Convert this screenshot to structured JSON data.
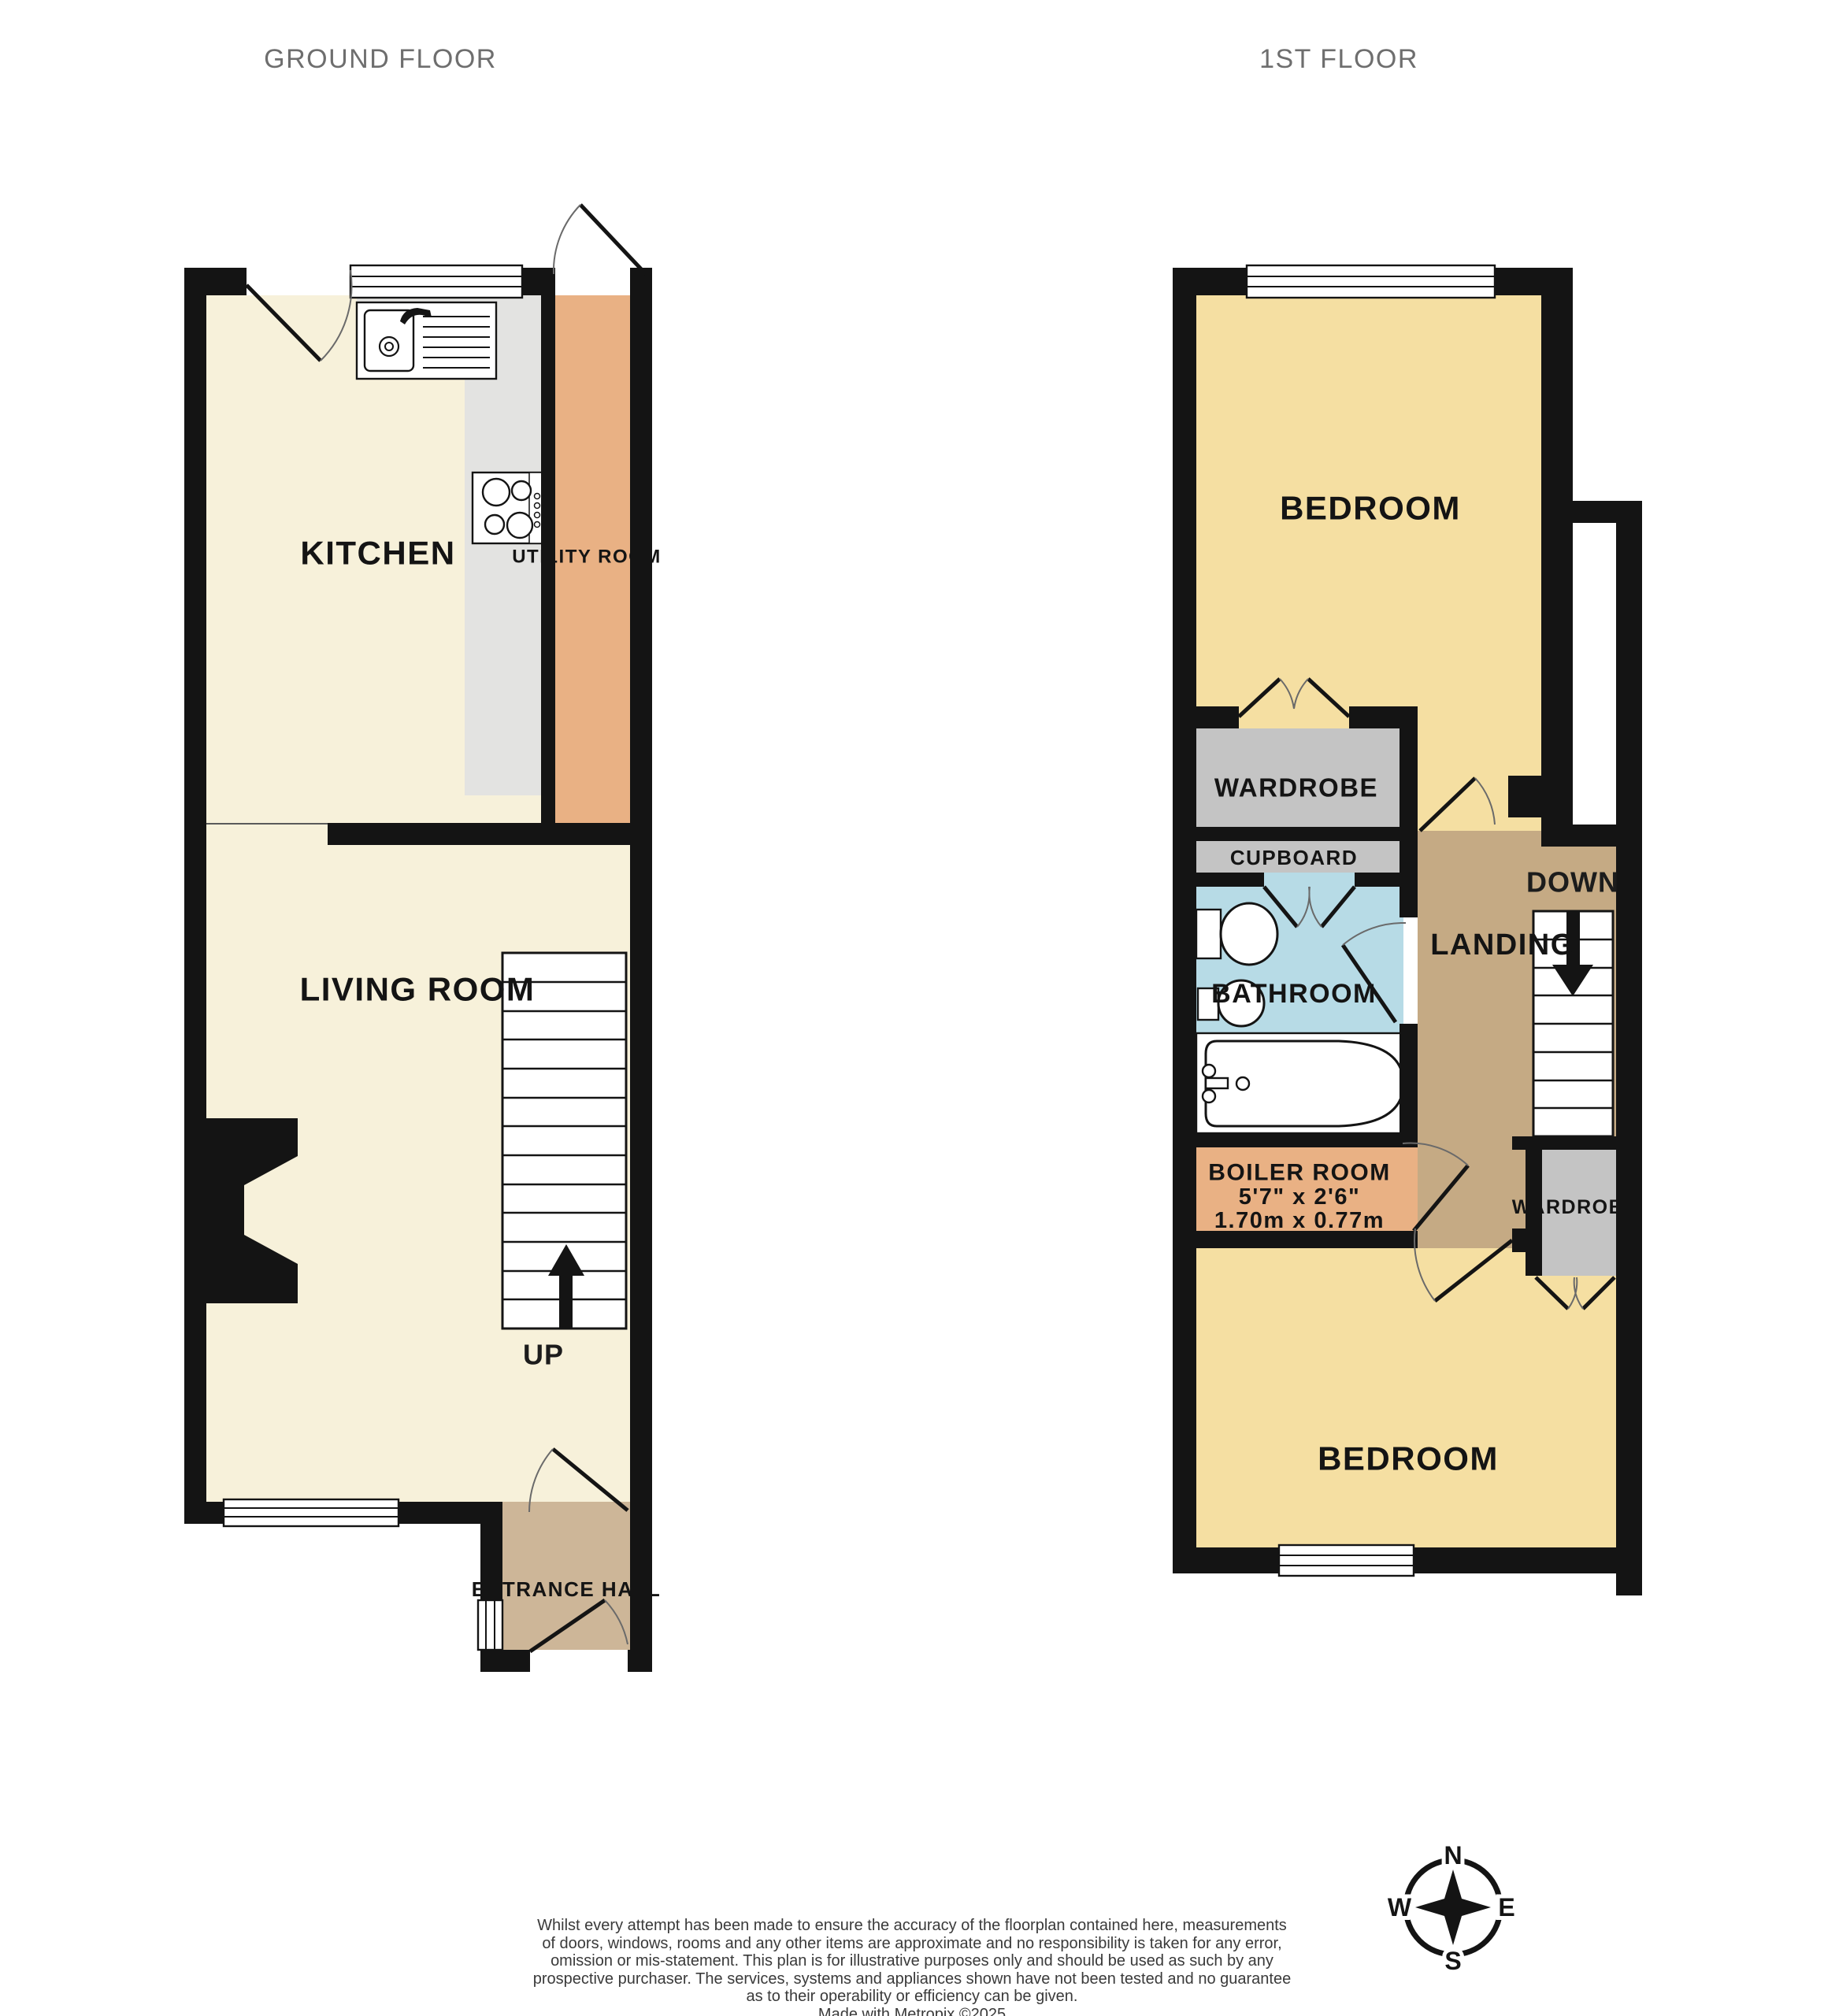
{
  "titles": {
    "ground_floor": "GROUND FLOOR",
    "first_floor": "1ST FLOOR"
  },
  "ground_floor": {
    "rooms": {
      "kitchen": "KITCHEN",
      "utility_room": "UTILITY ROOM",
      "living_room": "LIVING ROOM",
      "entrance_hall": "ENTRANCE HALL"
    },
    "stair_direction": "UP"
  },
  "first_floor": {
    "rooms": {
      "bedroom_front": "BEDROOM",
      "wardrobe_front": "WARDROBE",
      "cupboard": "CUPBOARD",
      "bathroom": "BATHROOM",
      "landing": "LANDING",
      "boiler_room": {
        "name": "BOILER ROOM",
        "size_imperial": "5'7\"  x 2'6\"",
        "size_metric": "1.70m  x 0.77m"
      },
      "wardrobe_back": "WARDROBE",
      "bedroom_back": "BEDROOM"
    },
    "stair_direction": "DOWN"
  },
  "compass": {
    "north": "N",
    "east": "E",
    "south": "S",
    "west": "W"
  },
  "disclaimer": {
    "lines": [
      "Whilst every attempt has been made to ensure the accuracy of the floorplan contained here, measurements",
      "of doors, windows, rooms and any other items are approximate and no responsibility is taken for any error,",
      "omission or mis-statement. This plan is for illustrative purposes only and should be used as such by any",
      "prospective purchaser. The services, systems and appliances shown have not been tested and no guarantee",
      "as to their operability or efficiency can be given."
    ],
    "credit": "Made with Metropix ©2025"
  },
  "colors": {
    "wall": "#141414",
    "floor_cream": "#f7f1da",
    "floor_yellow": "#f5dfa2",
    "floor_orange": "#e9b184",
    "floor_hall_tan": "#cdb698",
    "floor_landing_tan": "#c5aa84",
    "floor_bathroom_blue": "#b7dbe6",
    "fixture_gray": "#c4c4c4",
    "counter_gray": "#e3e3e1",
    "title_gray": "#6e6e6e"
  }
}
